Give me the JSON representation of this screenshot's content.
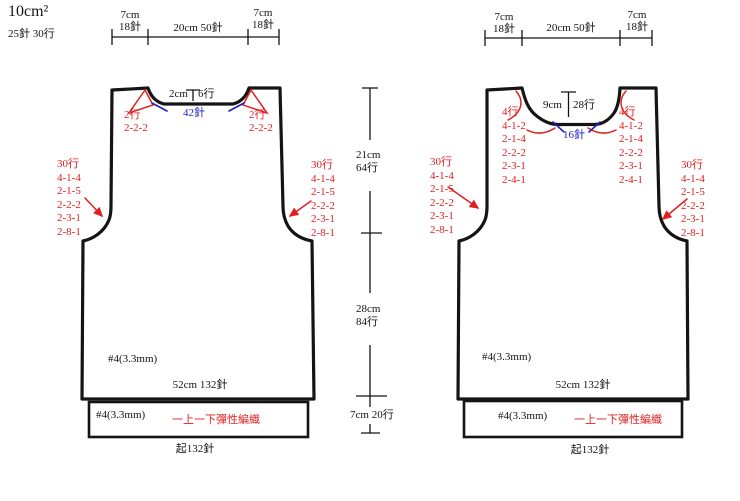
{
  "colors": {
    "outline": "#141414",
    "annotation_red": "#e01f1f",
    "annotation_blue": "#1f1fbf"
  },
  "gauge": {
    "size_label": "10cm²",
    "tension_label": "25針   30行"
  },
  "side_dims": {
    "upper": [
      "21cm",
      "64行"
    ],
    "middle": [
      "28cm",
      "84行"
    ],
    "lower": "7cm   20行"
  },
  "back": {
    "top_dims": {
      "left": [
        "7cm",
        "18針"
      ],
      "center": "20cm   50針",
      "right": [
        "7cm",
        "18針"
      ]
    },
    "neck": {
      "depth": "2cm",
      "rows": "6行",
      "stitches": "42針",
      "shaping_left": [
        "2行",
        "2-2-2"
      ],
      "shaping_right": [
        "2行",
        "2-2-2"
      ]
    },
    "armhole_shaping_left": [
      "30行",
      "4-1-4",
      "2-1-5",
      "2-2-2",
      "2-3-1",
      "2-8-1"
    ],
    "armhole_shaping_right": [
      "30行",
      "4-1-4",
      "2-1-5",
      "2-2-2",
      "2-3-1",
      "2-8-1"
    ],
    "needle": "#4(3.3mm)",
    "bottom_width": "52cm   132針",
    "band": {
      "needle": "#4(3.3mm)",
      "stitch_label": "一上一下彈性編織",
      "cast_on": "起132針"
    }
  },
  "front": {
    "top_dims": {
      "left": [
        "7cm",
        "18針"
      ],
      "center": "20cm   50針",
      "right": [
        "7cm",
        "18針"
      ]
    },
    "neck": {
      "depth": "9cm",
      "rows": "28行",
      "stitches": "16針",
      "shaping_left": [
        "4行",
        "4-1-2",
        "2-1-4",
        "2-2-2",
        "2-3-1",
        "2-4-1"
      ],
      "shaping_right": [
        "4行",
        "4-1-2",
        "2-1-4",
        "2-2-2",
        "2-3-1",
        "2-4-1"
      ]
    },
    "armhole_shaping_left": [
      "30行",
      "4-1-4",
      "2-1-5",
      "2-2-2",
      "2-3-1",
      "2-8-1"
    ],
    "armhole_shaping_right": [
      "30行",
      "4-1-4",
      "2-1-5",
      "2-2-2",
      "2-3-1",
      "2-8-1"
    ],
    "needle": "#4(3.3mm)",
    "bottom_width": "52cm   132針",
    "band": {
      "needle": "#4(3.3mm)",
      "stitch_label": "一上一下彈性編織",
      "cast_on": "起132針"
    }
  }
}
